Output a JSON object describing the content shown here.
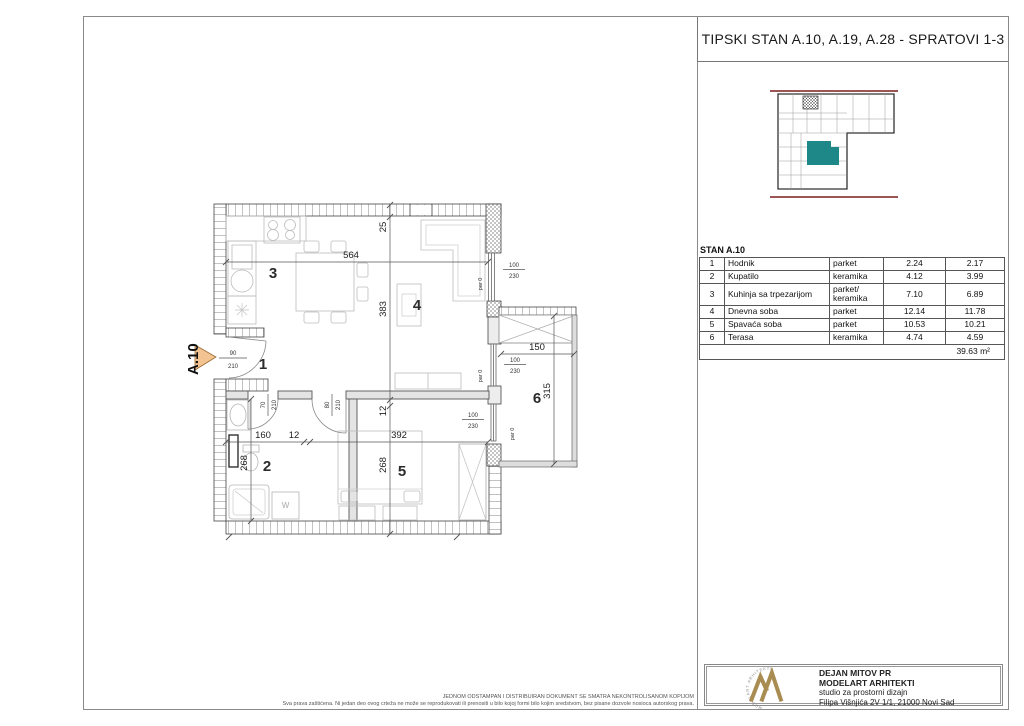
{
  "title": "TIPSKI STAN A.10, A.19, A.28 - SPRATOVI 1-3",
  "stan_label": "STAN A.10",
  "key_plan": {
    "highlight_color": "#1E8889",
    "street_line_color": "#7D1F1F"
  },
  "table": {
    "rows": [
      {
        "num": "1",
        "name": "Hodnik",
        "floor": "parket",
        "area": "2.24",
        "area2": "2.17"
      },
      {
        "num": "2",
        "name": "Kupatilo",
        "floor": "keramika",
        "area": "4.12",
        "area2": "3.99"
      },
      {
        "num": "3",
        "name": "Kuhinja sa trpezarijom",
        "floor": "parket/ keramika",
        "area": "7.10",
        "area2": "6.89"
      },
      {
        "num": "4",
        "name": "Dnevna soba",
        "floor": "parket",
        "area": "12.14",
        "area2": "11.78"
      },
      {
        "num": "5",
        "name": "Spavaća soba",
        "floor": "parket",
        "area": "10.53",
        "area2": "10.21"
      },
      {
        "num": "6",
        "name": "Terasa",
        "floor": "keramika",
        "area": "4.74",
        "area2": "4.59"
      }
    ],
    "total": "39.63 m²"
  },
  "plan": {
    "entry_label": "A.10",
    "rooms": {
      "hallway": "1",
      "bathroom": "2",
      "kitchen": "3",
      "living": "4",
      "bedroom": "5",
      "terrace": "6"
    },
    "dims": {
      "top_width": "564",
      "top_niche": "25",
      "living_depth": "383",
      "wall_thin": "12",
      "bath_width": "160",
      "bed_width": "392",
      "room_depth": "268",
      "terrace_width": "150",
      "terrace_depth": "315"
    },
    "openings": {
      "win_w": "100",
      "win_h": "230",
      "parapet": "par 0",
      "entry_w": "90",
      "entry_h": "210",
      "door1_w": "70",
      "door2_w": "80",
      "door_h": "210"
    },
    "washer": "W",
    "arrow_color": "#F3C492"
  },
  "firm": {
    "name": "DEJAN MITOV PR",
    "studio": "MODELART ARHITEKTI",
    "tagline": "studio za prostorni dizajn",
    "address": "Filipa Višnjića 2V 1/1, 21000 Novi Sad",
    "logo_text": "MODELART ARHITEKTI",
    "logo_color": "#A88C52"
  },
  "disclaimer": {
    "line1": "JEDNOM ODSTAMPAN I DISTRIBUIRAN DOKUMENT SE SMATRA NEKONTROLISANOM KOPIJOM",
    "line2": "Sva prava zaštićena. Ni jedan deo ovog crteža ne može se reprodukovati ili prenositi u bilo kojoj formi bilo kojim sredstvom, bez pisane dozvole nosioca autorskog prava."
  }
}
